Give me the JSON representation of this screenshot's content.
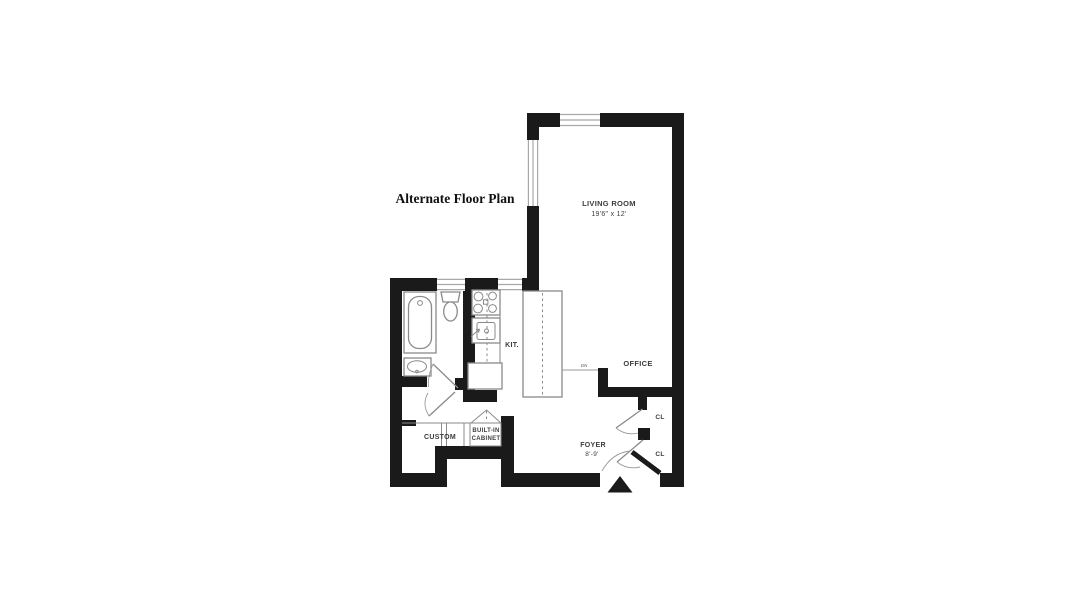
{
  "title": "Alternate Floor Plan",
  "plan": {
    "living_room": {
      "label": "LIVING ROOM",
      "dimensions": "19'6\" x 12'"
    },
    "kitchen": {
      "label": "KIT."
    },
    "office": {
      "label": "OFFICE"
    },
    "foyer": {
      "label": "FOYER",
      "dimensions": "8'-9'"
    },
    "closet_upper": {
      "label": "CL"
    },
    "closet_lower": {
      "label": "CL"
    },
    "custom_closet": {
      "label": "CUSTOM"
    },
    "built_in_cabinet": {
      "label_line1": "BUILT-IN",
      "label_line2": "CABINET"
    },
    "annotation_dn": "DN"
  },
  "colors": {
    "background": "#ffffff",
    "wall": "#1a1a1a",
    "fixture_outline": "#8a8a8a",
    "window_line": "#a8a8a8",
    "label_text": "#3c3c3c"
  }
}
